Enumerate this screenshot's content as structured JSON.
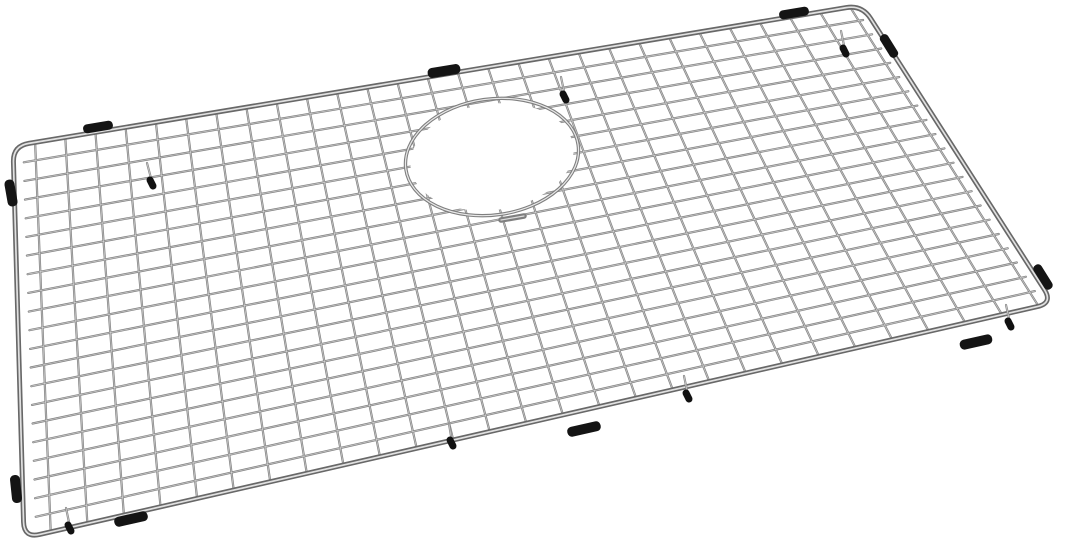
{
  "scene": {
    "alt_text": "Stainless steel wire bottom grid for a kitchen sink, angled product photo on a white background, with a round drain opening near the upper middle, black rubber bumpers along the frame edges and small black-tipped feet",
    "background_color": "#ffffff",
    "width": 1080,
    "height": 549
  },
  "colors": {
    "wire_dark": "#7b7b7b",
    "wire_light": "#ffffff",
    "frame_dark": "#686868",
    "frame_light": "#eeeeee",
    "ring_dark": "#7f7f7f",
    "ring_light": "#f4f4f4",
    "bumper_black": "#141414",
    "foot_stem": "#8a8a8a",
    "foot_tip": "#111111"
  },
  "grid": {
    "corners": {
      "tl": [
        13,
        146
      ],
      "tr": [
        862,
        5
      ],
      "br": [
        1053,
        303
      ],
      "bl": [
        24,
        538
      ]
    },
    "corner_radius": 16,
    "row_wires": 20,
    "col_wires": 28,
    "row_v_span": [
      0.046,
      0.953
    ],
    "col_u_span": [
      0.026,
      0.986
    ],
    "row_u_extent": [
      0.012,
      0.991
    ],
    "col_v_extent": [
      0.006,
      0.993
    ],
    "grid_stroke_width": 2.2,
    "grid_highlight_width": 0.8,
    "frame_stroke_width": 5.0,
    "frame_highlight_width": 1.7
  },
  "drain_opening": {
    "cx": 492,
    "cy": 157,
    "rx": 87,
    "ry": 58,
    "rotation": -8,
    "ring_stroke_width": 3.4,
    "ring_highlight_width": 1.2,
    "inner_fill_rx": 82,
    "inner_fill_ry": 53,
    "stub": {
      "x1": 501,
      "y1": 220,
      "x2": 524,
      "y2": 216,
      "width": 5.5
    }
  },
  "bumpers": [
    {
      "cx": 98,
      "cy": 127,
      "rot": -9.5,
      "len": 30,
      "th": 9
    },
    {
      "cx": 444,
      "cy": 71,
      "rot": -9.5,
      "len": 33,
      "th": 10
    },
    {
      "cx": 794,
      "cy": 13,
      "rot": -9.5,
      "len": 30,
      "th": 9
    },
    {
      "cx": 11,
      "cy": 193,
      "rot": 80,
      "len": 27,
      "th": 10
    },
    {
      "cx": 16,
      "cy": 489,
      "rot": 84,
      "len": 28,
      "th": 10
    },
    {
      "cx": 131,
      "cy": 519,
      "rot": -12.5,
      "len": 34,
      "th": 10
    },
    {
      "cx": 584,
      "cy": 429,
      "rot": -12.5,
      "len": 34,
      "th": 10
    },
    {
      "cx": 976,
      "cy": 342,
      "rot": -12.5,
      "len": 33,
      "th": 10
    },
    {
      "cx": 889,
      "cy": 46,
      "rot": 58,
      "len": 26,
      "th": 9
    },
    {
      "cx": 1043,
      "cy": 277,
      "rot": 58,
      "len": 28,
      "th": 9
    }
  ],
  "feet": [
    {
      "stem": [
        147,
        163,
        152,
        186
      ]
    },
    {
      "stem": [
        561,
        77,
        565,
        100
      ]
    },
    {
      "stem": [
        841,
        31,
        845,
        54
      ]
    },
    {
      "stem": [
        1006,
        305,
        1010,
        327
      ]
    },
    {
      "stem": [
        684,
        376,
        688,
        399
      ]
    },
    {
      "stem": [
        449,
        424,
        452,
        446
      ]
    },
    {
      "stem": [
        66,
        508,
        70,
        531
      ]
    }
  ]
}
